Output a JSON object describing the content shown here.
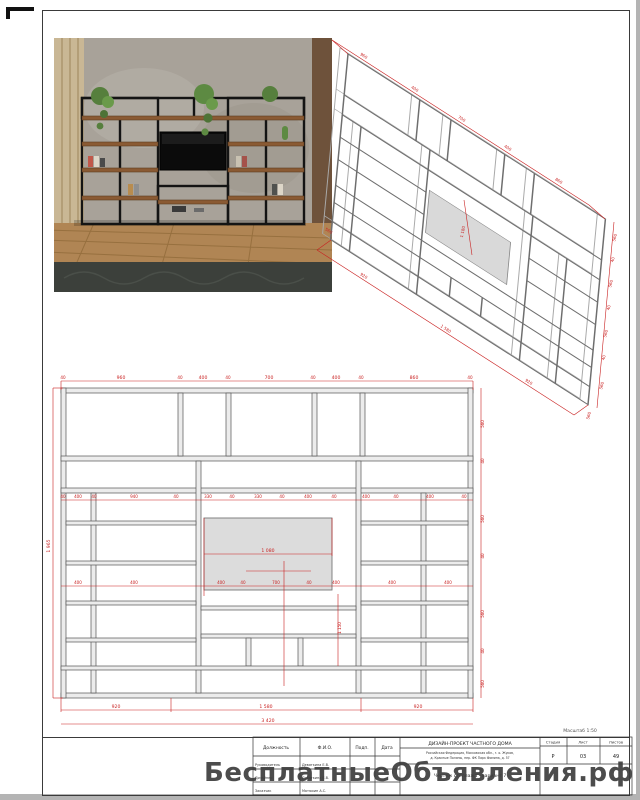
{
  "sheet": {
    "watermark": "БесплатныеОбъявления.рф",
    "scale_note": "Масштаб 1:50"
  },
  "title_block": {
    "col_position": "Должность",
    "col_name": "Ф.И.О.",
    "col_sign": "Подп.",
    "col_date": "Дата",
    "rows": [
      {
        "position": "Руководитель",
        "name": "Девяткина Е.В."
      },
      {
        "position": "Дизайнер",
        "name": "Девяткина Е.В."
      },
      {
        "position": "Заказчик",
        "name": "Матюхин А.С."
      }
    ],
    "project_title": "ДИЗАЙН-ПРОЕКТ ЧАСТНОГО ДОМА",
    "address_line1": "Российская Федерация, Московская обл., г. о. Жуков,",
    "address_line2": "д. Красные Поляны, пер. ФК Парк Фомина, д. 57",
    "drawing_title": "Чертеж стеллажа - вариант 7",
    "stage_label": "Стадия",
    "stage_value": "Р",
    "sheet_label": "Лист",
    "sheet_value": "03",
    "sheets_label": "Листов",
    "sheets_value": "49"
  },
  "elevation": {
    "top_dims": [
      "40",
      "960",
      "40",
      "400",
      "40",
      "700",
      "40",
      "400",
      "40",
      "860",
      "40"
    ],
    "row2_dims": [
      "40",
      "400",
      "40",
      "940",
      "40",
      "330",
      "40",
      "330",
      "40",
      "400",
      "40",
      "400",
      "40",
      "400",
      "40"
    ],
    "mid_dims": [
      "400",
      "400",
      "400",
      "40",
      "700",
      "40",
      "400",
      "400",
      "400"
    ],
    "tv_width": "1 080",
    "center_height": "1 150",
    "total_height": "1 965",
    "right_dims": [
      "560",
      "40",
      "560",
      "40",
      "560",
      "40",
      "560"
    ],
    "bottom_dims": [
      "920",
      "1 580",
      "920"
    ],
    "total_width": "3 420"
  },
  "iso": {
    "top_dims": [
      "960",
      "400",
      "700",
      "400",
      "860"
    ],
    "right_dims": [
      "560",
      "40",
      "560",
      "40",
      "560",
      "40",
      "560"
    ],
    "bottom_dims": [
      "920",
      "1 580",
      "920"
    ],
    "depth": "560",
    "tv_height": "1 180"
  }
}
